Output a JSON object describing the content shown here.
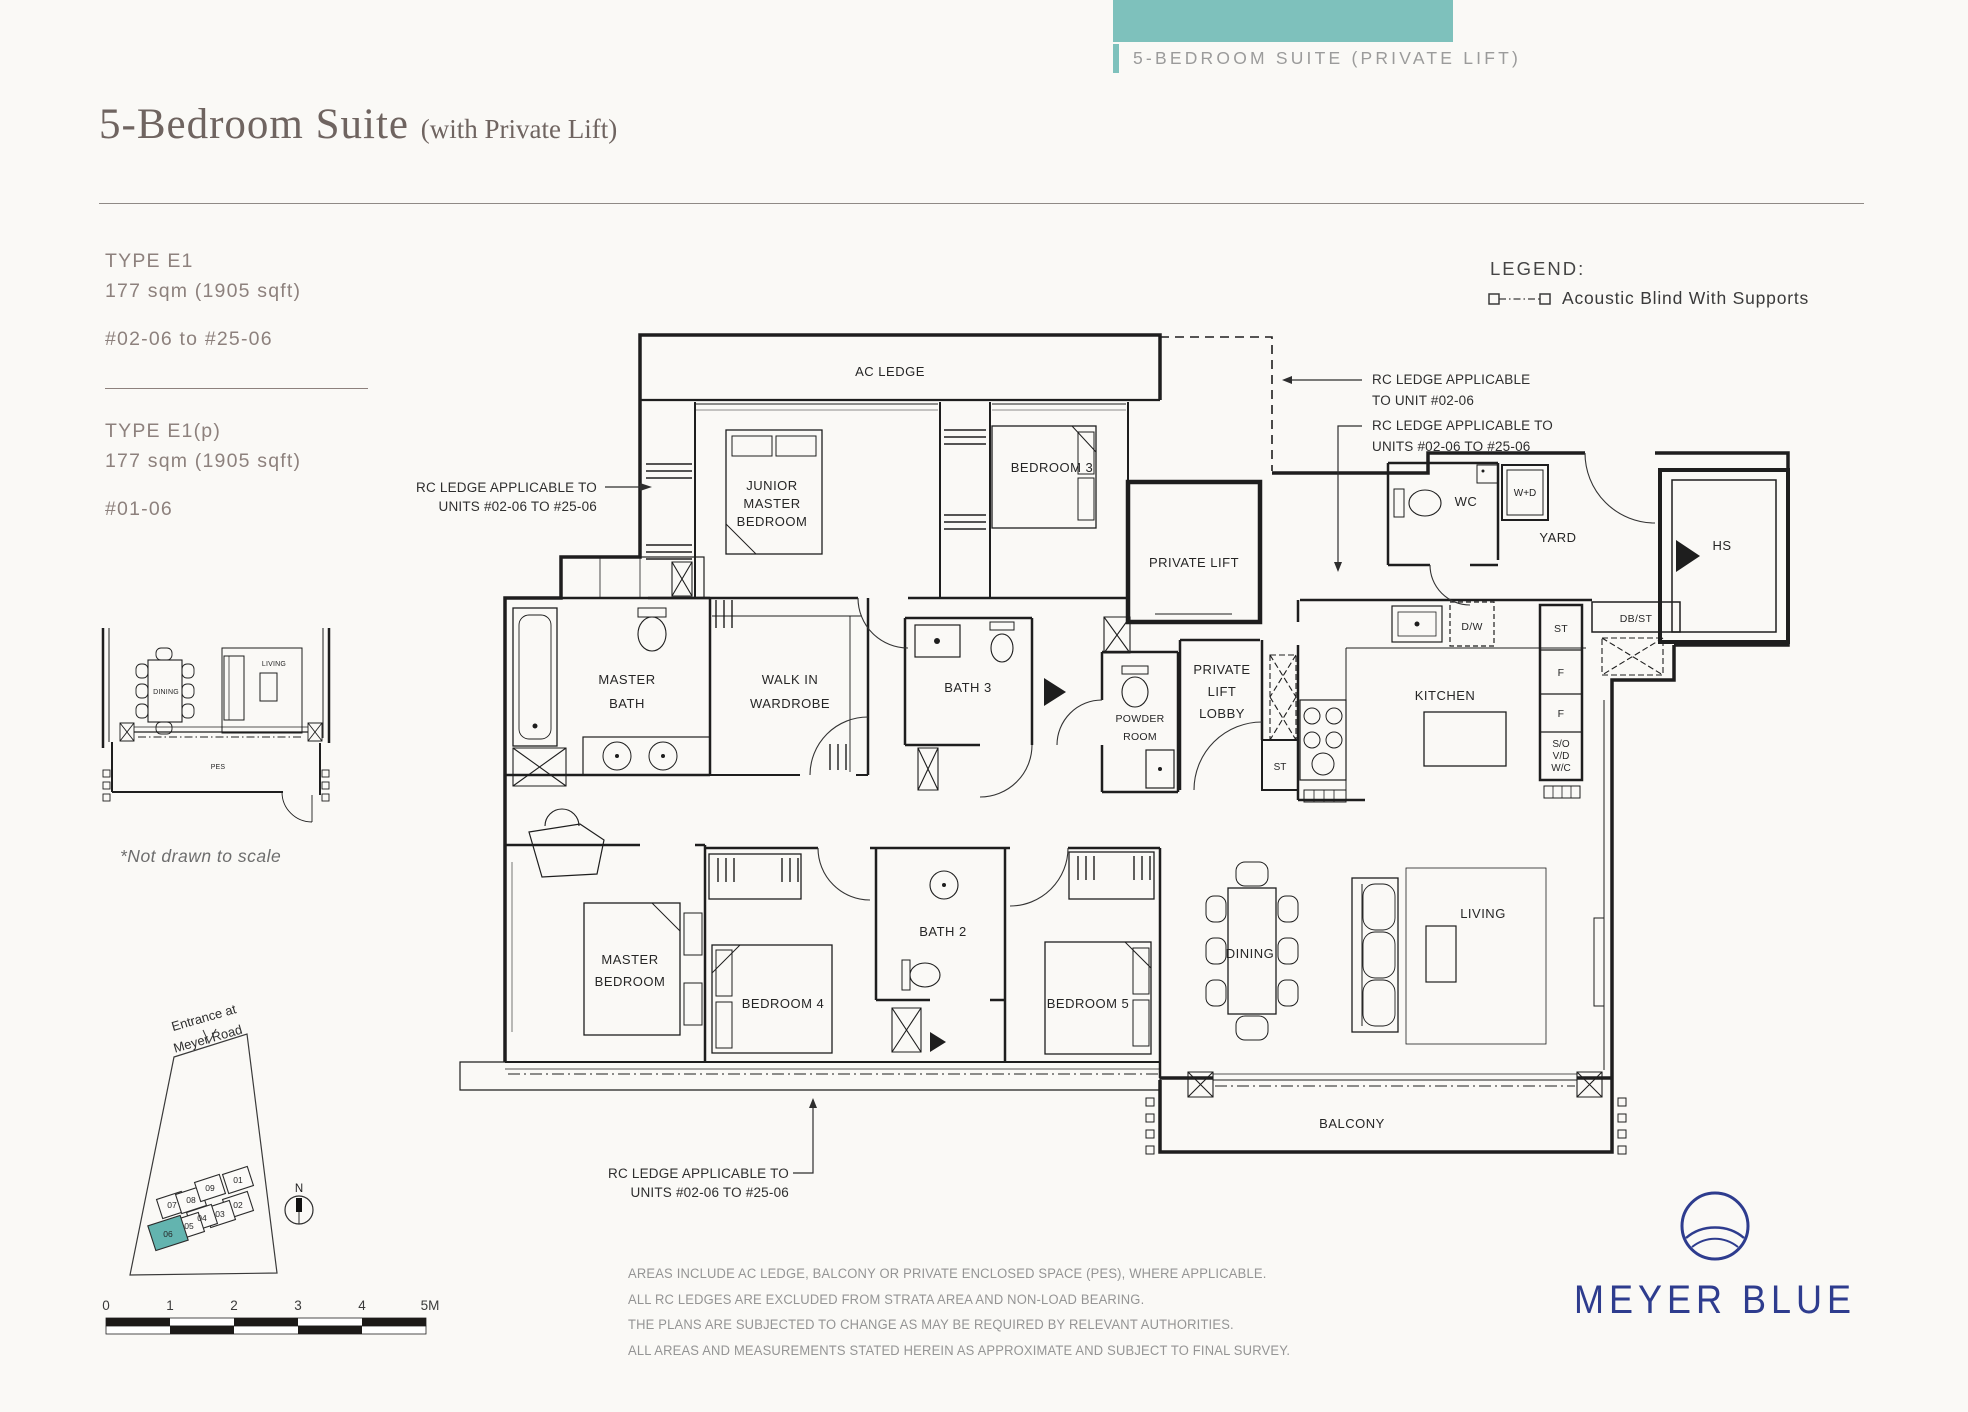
{
  "colors": {
    "teal": "#7ec1bc",
    "teal_highlight": "#63b4af",
    "navy": "#2e3c8e"
  },
  "banner": {
    "label": "5-BEDROOM SUITE (PRIVATE LIFT)"
  },
  "header": {
    "title": "5-Bedroom Suite",
    "subtitle": "(with Private Lift)"
  },
  "sidebar": {
    "type_e1": {
      "name": "TYPE E1",
      "area": "177 sqm (1905 sqft)",
      "units": "#02-06 to #25-06"
    },
    "type_e1p": {
      "name": "TYPE E1(p)",
      "area": "177 sqm (1905 sqft)",
      "units": "#01-06"
    },
    "not_to_scale": "*Not drawn to scale"
  },
  "legend": {
    "heading": "LEGEND:",
    "item": "Acoustic Blind With Supports"
  },
  "thumbnail": {
    "dining": "DINING",
    "living": "LIVING",
    "pes": "PES"
  },
  "sitemap": {
    "entrance_line1": "Entrance at",
    "entrance_line2": "Meyer Road",
    "north": "N",
    "buildings": [
      "01",
      "02",
      "03",
      "04",
      "05",
      "06",
      "07",
      "08",
      "09"
    ]
  },
  "scalebar": {
    "ticks": [
      "0",
      "1",
      "2",
      "3",
      "4",
      "5M"
    ]
  },
  "plan": {
    "labels": {
      "ac_ledge": "AC LEDGE",
      "junior_1": "JUNIOR",
      "junior_2": "MASTER",
      "junior_3": "BEDROOM",
      "bedroom3": "BEDROOM 3",
      "private_lift": "PRIVATE LIFT",
      "wc": "WC",
      "wd": "W+D",
      "yard": "YARD",
      "hs": "HS",
      "dbst": "DB/ST",
      "master_bath_1": "MASTER",
      "master_bath_2": "BATH",
      "wiw_1": "WALK IN",
      "wiw_2": "WARDROBE",
      "bath3": "BATH 3",
      "powder_1": "POWDER",
      "powder_2": "ROOM",
      "lobby_1": "PRIVATE",
      "lobby_2": "LIFT",
      "lobby_3": "LOBBY",
      "st_lobby": "ST",
      "kitchen": "KITCHEN",
      "dw": "D/W",
      "st_col": "ST",
      "f1": "F",
      "f2": "F",
      "sovd_1": "S/O",
      "sovd_2": "V/D",
      "sovd_3": "W/C",
      "master_bed_1": "MASTER",
      "master_bed_2": "BEDROOM",
      "bedroom4": "BEDROOM 4",
      "bath2": "BATH 2",
      "bedroom5": "BEDROOM 5",
      "dining": "DINING",
      "living": "LIVING",
      "balcony": "BALCONY"
    },
    "annotations": {
      "left_1": "RC LEDGE APPLICABLE TO",
      "left_2": "UNITS #02-06 TO #25-06",
      "right1_1": "RC LEDGE APPLICABLE",
      "right1_2": "TO UNIT #02-06",
      "right2_1": "RC LEDGE APPLICABLE TO",
      "right2_2": "UNITS #02-06 TO #25-06",
      "bottom_1": "RC LEDGE APPLICABLE TO",
      "bottom_2": "UNITS #02-06 TO #25-06"
    }
  },
  "footer": {
    "disclaimer": [
      "AREAS INCLUDE AC LEDGE, BALCONY OR PRIVATE ENCLOSED SPACE (PES), WHERE APPLICABLE.",
      "ALL RC LEDGES ARE EXCLUDED FROM STRATA AREA AND NON-LOAD BEARING.",
      "THE PLANS ARE SUBJECTED TO CHANGE AS MAY BE REQUIRED BY RELEVANT AUTHORITIES.",
      "ALL AREAS AND MEASUREMENTS STATED HEREIN AS APPROXIMATE AND SUBJECT TO FINAL SURVEY."
    ],
    "logo": "MEYER BLUE"
  }
}
